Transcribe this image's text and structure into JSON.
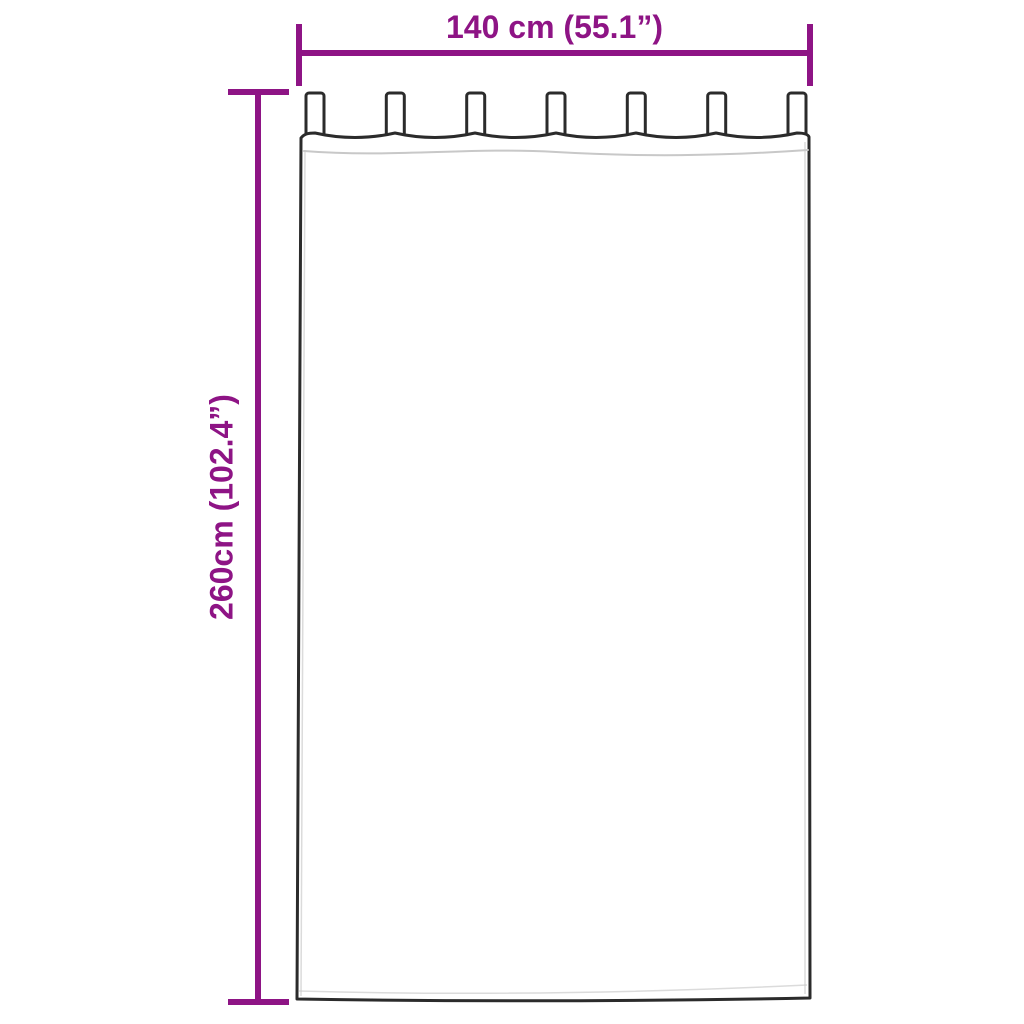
{
  "diagram": {
    "type": "product-dimension-diagram",
    "subject": "tab-top curtain panel",
    "tabs_count": 7
  },
  "labels": {
    "width": "140 cm (55.1”)",
    "height": "260cm (102.4”)"
  },
  "dimensions": {
    "width_cm": "140",
    "width_in": "55.1",
    "height_cm": "260",
    "height_in": "102.4"
  },
  "colors": {
    "dimension_accent": "#8E1485",
    "curtain_outline": "#2B2B2B",
    "seam_line": "#C8C8C8",
    "background": "#FFFFFF"
  }
}
